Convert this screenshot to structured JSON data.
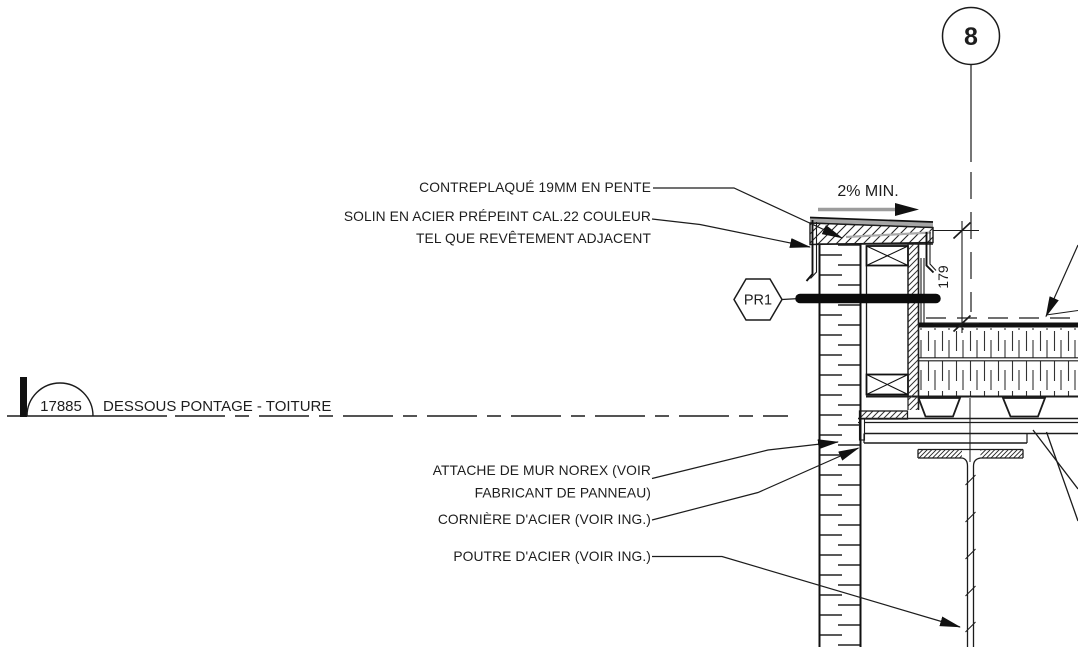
{
  "grid": {
    "bubble_label": "8"
  },
  "slope": {
    "label": "2% MIN."
  },
  "dimension": {
    "value": "179"
  },
  "wall_tag": {
    "label": "PR1"
  },
  "datum": {
    "elevation": "17885",
    "label": "DESSOUS PONTAGE - TOITURE"
  },
  "annotations": {
    "plywood": "CONTREPLAQUÉ 19MM EN PENTE",
    "flashing_l1": "SOLIN EN ACIER PRÉPEINT CAL.22 COULEUR",
    "flashing_l2": "TEL QUE REVÊTEMENT ADJACENT",
    "attachment_l1": "ATTACHE DE MUR NOREX (VOIR",
    "attachment_l2": "FABRICANT DE PANNEAU)",
    "angle": "CORNIÈRE D'ACIER (VOIR ING.)",
    "beam": "POUTRE D'ACIER (VOIR ING.)"
  },
  "colors": {
    "line": "#1b1b1b",
    "flashing_gray": "#a6a6a6",
    "background": "#ffffff"
  }
}
